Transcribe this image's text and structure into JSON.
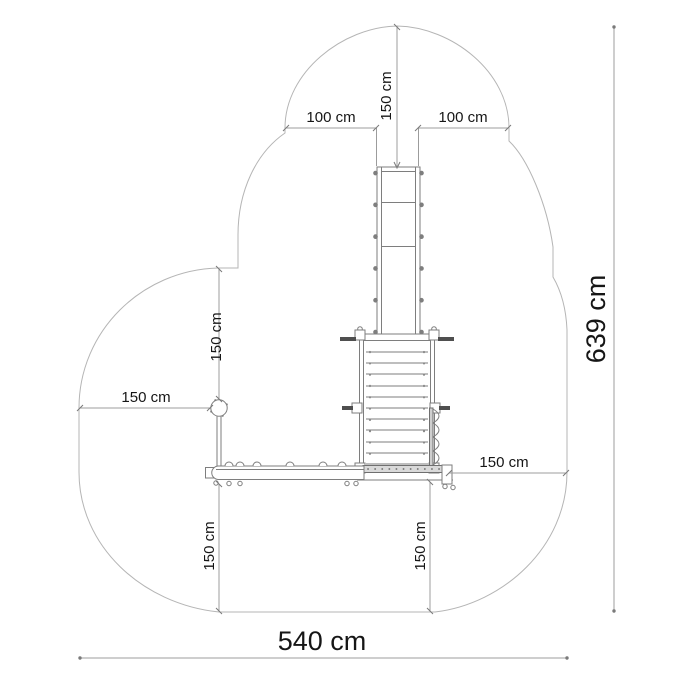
{
  "drawing": {
    "type": "playground-equipment-safety-zone-plan",
    "units": "cm",
    "labels": {
      "top_clearance": "150 cm",
      "top_left": "100 cm",
      "top_right": "100 cm",
      "upper_left_vertical": "150 cm",
      "left_horizontal": "150 cm",
      "right_horizontal": "150 cm",
      "bottom_left_vertical": "150 cm",
      "bottom_right_vertical": "150 cm",
      "total_width": "540 cm",
      "total_height": "639 cm"
    },
    "values": {
      "total_width_cm": 540,
      "total_height_cm": 639,
      "side_clearance_cm": 150,
      "slide_exit_side_clearance_cm": 100
    },
    "colors": {
      "background": "#ffffff",
      "safety_zone_outline": "#b5b5b5",
      "structure_lines": "#7e7e7e",
      "dimension_lines": "#9c9c9c",
      "text": "#161616"
    }
  }
}
